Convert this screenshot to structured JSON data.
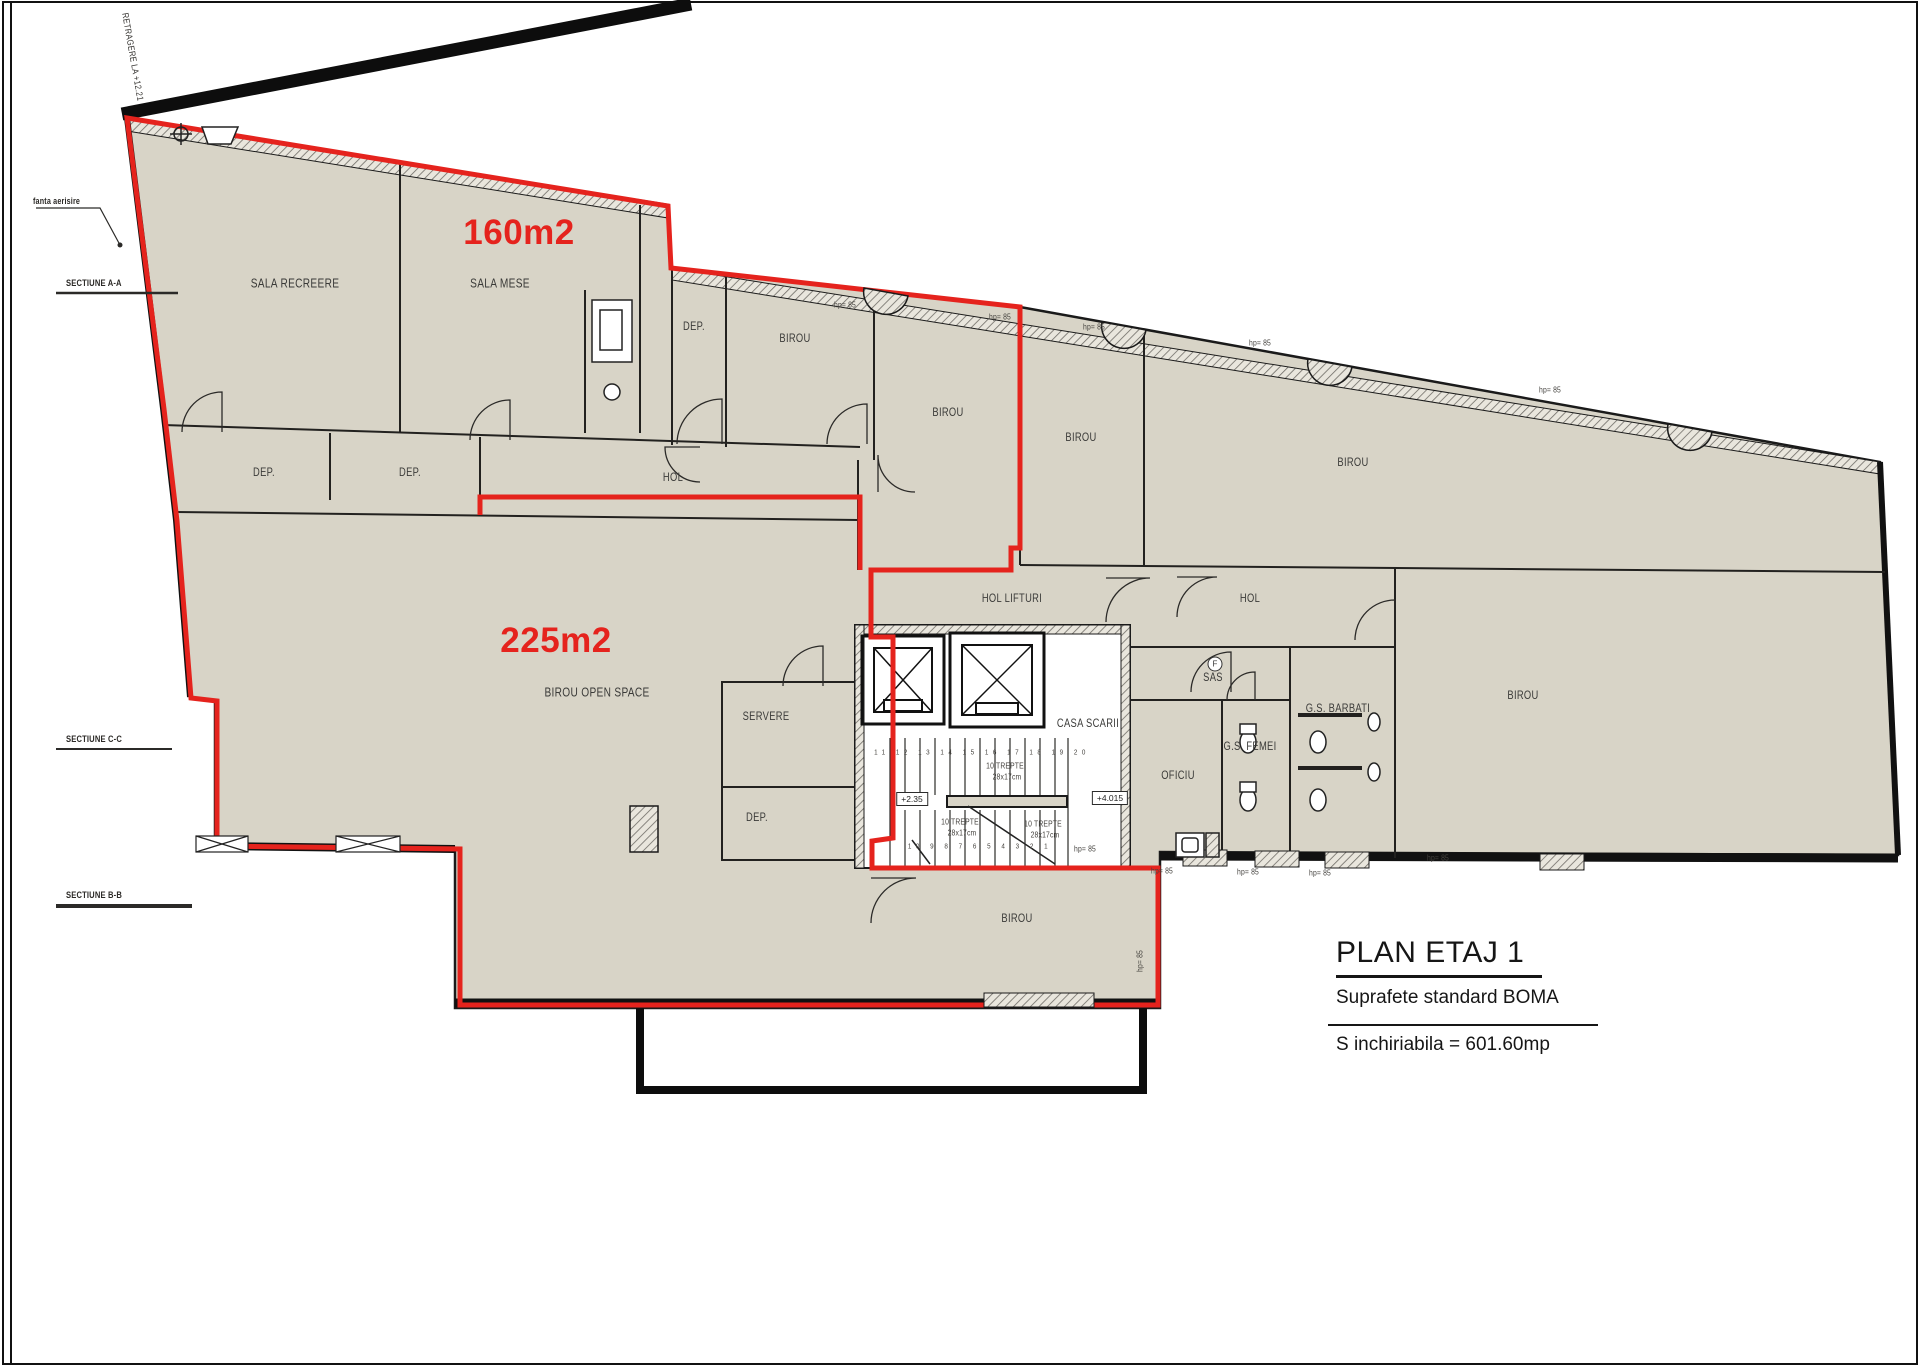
{
  "page": {
    "title": "PLAN ETAJ 1",
    "subtitle": "Suprafete standard BOMA",
    "rentable_area": "S inchiriabila = 601.60mp"
  },
  "zones": [
    {
      "label": "160m2"
    },
    {
      "label": "225m2"
    }
  ],
  "rooms": [
    {
      "label": "SALA RECREERE"
    },
    {
      "label": "SALA MESE"
    },
    {
      "label": "DEP."
    },
    {
      "label": "BIROU"
    },
    {
      "label": "BIROU"
    },
    {
      "label": "BIROU"
    },
    {
      "label": "BIROU"
    },
    {
      "label": "HOL"
    },
    {
      "label": "DEP."
    },
    {
      "label": "DEP."
    },
    {
      "label": "HOL LIFTURI"
    },
    {
      "label": "HOL"
    },
    {
      "label": "SAS"
    },
    {
      "label": "CASA SCARII"
    },
    {
      "label": "G.S. BARBATI"
    },
    {
      "label": "G.S. FEMEI"
    },
    {
      "label": "OFICIU"
    },
    {
      "label": "SERVERE"
    },
    {
      "label": "DEP."
    },
    {
      "label": "BIROU OPEN SPACE"
    },
    {
      "label": "BIROU"
    },
    {
      "label": "BIROU"
    }
  ],
  "annotations": {
    "setback": "RETRAGERE LA +12.21",
    "vent_note": "fanta aerisire",
    "sections": [
      {
        "label": "SECTIUNE A-A"
      },
      {
        "label": "SECTIUNE C-C"
      },
      {
        "label": "SECTIUNE B-B"
      }
    ],
    "window_label": "hp= 85",
    "stair_text_line1": "10 TREPTE",
    "stair_text_line2": "28x17cm",
    "stair_numbers_top": "11 12 13 14 15 16 17 18 19 20",
    "stair_numbers_bottom": "10 9 8 7 6 5 4 3 2 1",
    "level_left": "+2.35",
    "level_right": "+4.015",
    "fire_symbol": "F"
  },
  "colors": {
    "lease_outline": "#e5231d",
    "floor_fill": "#d8d4c7",
    "wall": "#1a1a1a"
  }
}
